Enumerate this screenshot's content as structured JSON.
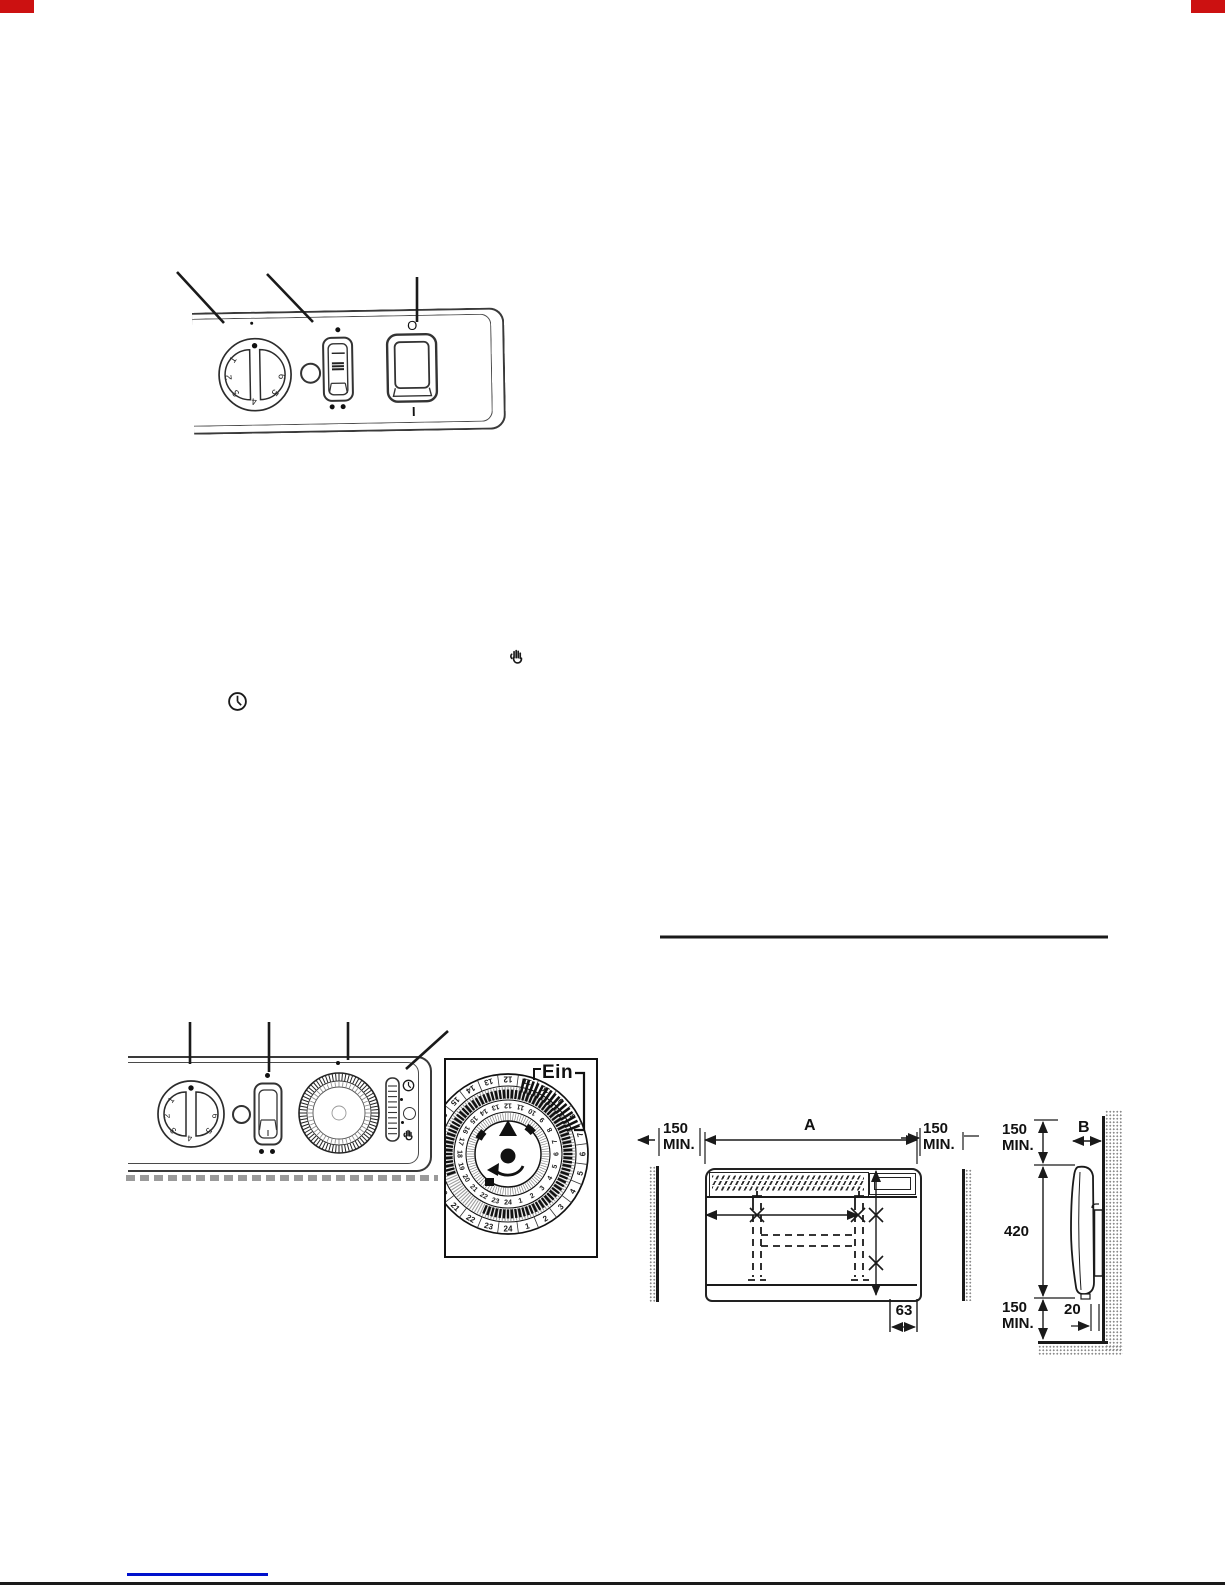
{
  "panel1": {
    "dial_numbers": [
      "1",
      "2",
      "3",
      "4",
      "5",
      "6"
    ],
    "power_off": "O",
    "power_on": "I"
  },
  "panel2": {
    "dial_numbers": [
      "1",
      "2",
      "3",
      "4",
      "5",
      "6"
    ]
  },
  "timer_detail": {
    "on_label": "Ein",
    "outer_numbers": [
      "1",
      "2",
      "3",
      "4",
      "5",
      "6",
      "7",
      "8",
      "9",
      "10",
      "11",
      "12",
      "13",
      "14",
      "15",
      "16",
      "17",
      "18",
      "19",
      "20",
      "21",
      "22",
      "23",
      "24"
    ],
    "inner_numbers": [
      "1",
      "2",
      "3",
      "4",
      "5",
      "6",
      "7",
      "8",
      "9",
      "10",
      "11",
      "12",
      "13",
      "14",
      "15",
      "16",
      "17",
      "18",
      "19",
      "20",
      "21",
      "22",
      "23",
      "24"
    ]
  },
  "dims": {
    "clearance": "150",
    "min": "MIN.",
    "width": "A",
    "bottom_offset": "63",
    "depth": "B",
    "height": "420",
    "wall_gap": "20"
  },
  "icons": {
    "hand": "hand-icon",
    "clock": "clock-icon"
  },
  "colors": {
    "corner_mark": "#cc1111",
    "link": "#0011cc",
    "ink": "#1a1a1a"
  }
}
